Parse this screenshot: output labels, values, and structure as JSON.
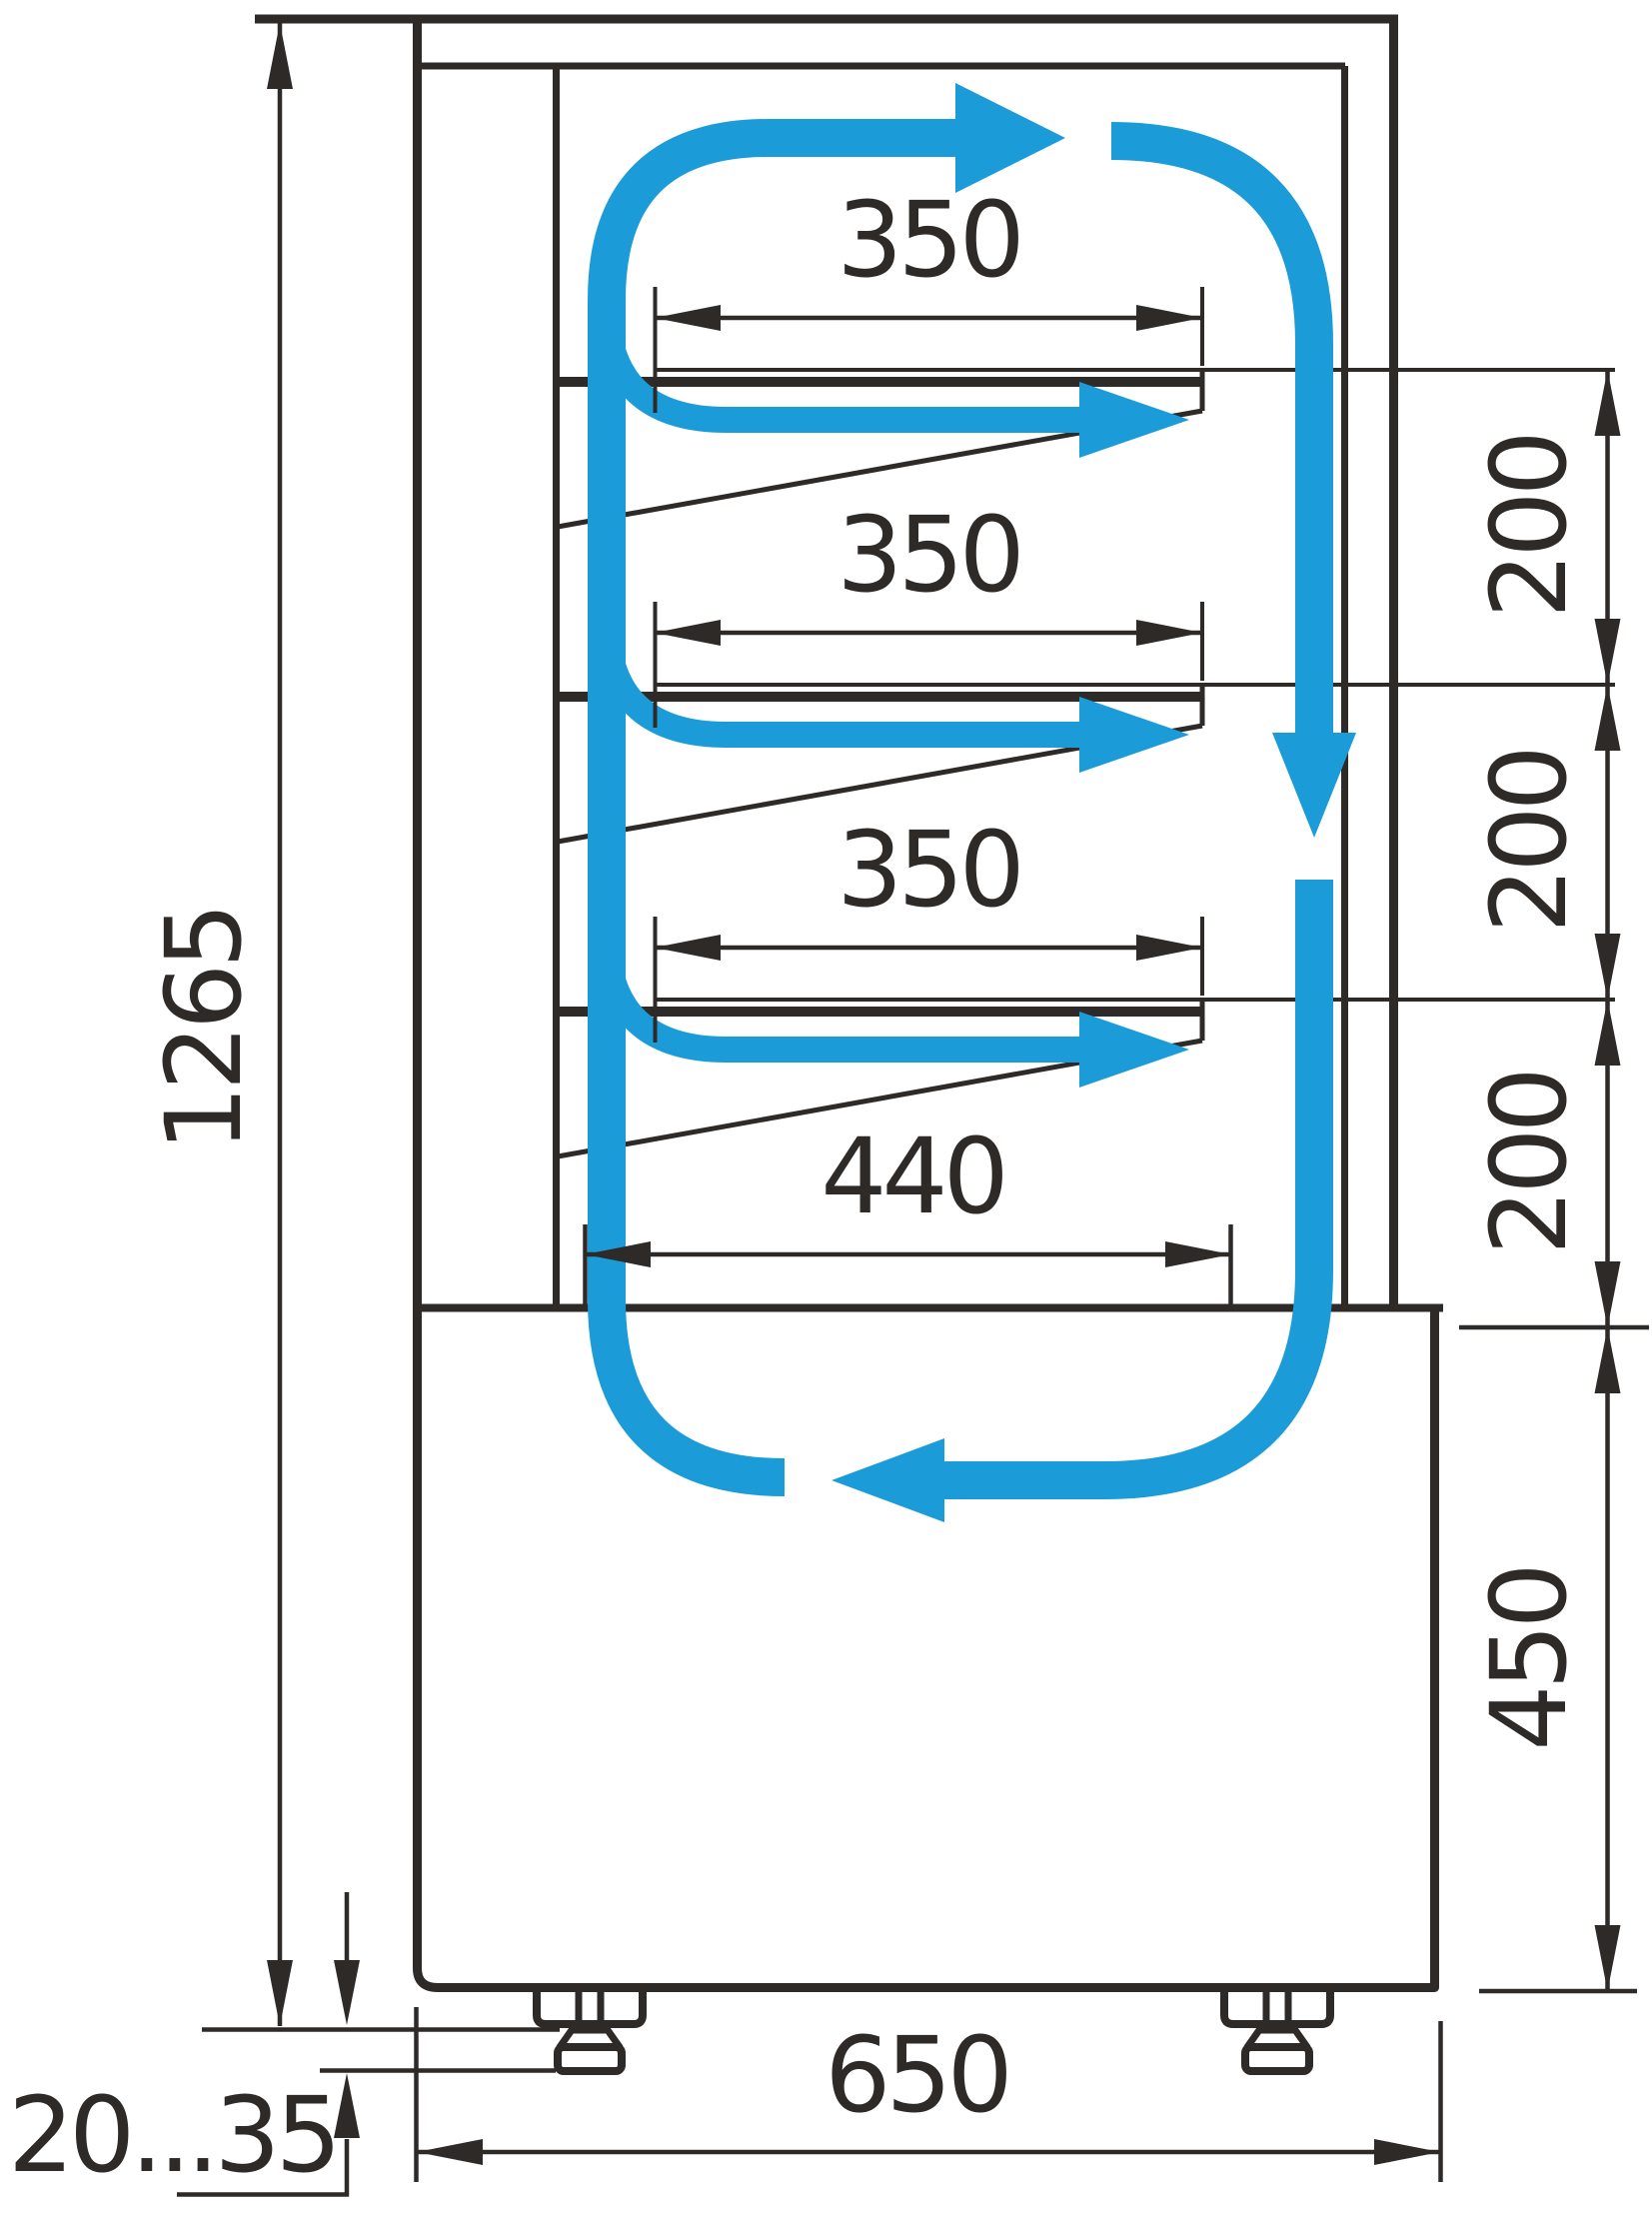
{
  "diagram": {
    "type": "refrigerated-display-case-side-section",
    "units": "mm",
    "dims": {
      "overall_height": "1265",
      "leg_adjust_range": "20...35",
      "overall_depth": "650",
      "well_height": "450",
      "shelf_width_1": "350",
      "shelf_width_2": "350",
      "shelf_width_3": "350",
      "bottom_shelf_width": "440",
      "shelf_spacing_1": "200",
      "shelf_spacing_2": "200",
      "shelf_spacing_3": "200"
    },
    "colors": {
      "line": "#2e2a28",
      "airflow": "#1b9cd9",
      "background": "#ffffff"
    }
  }
}
